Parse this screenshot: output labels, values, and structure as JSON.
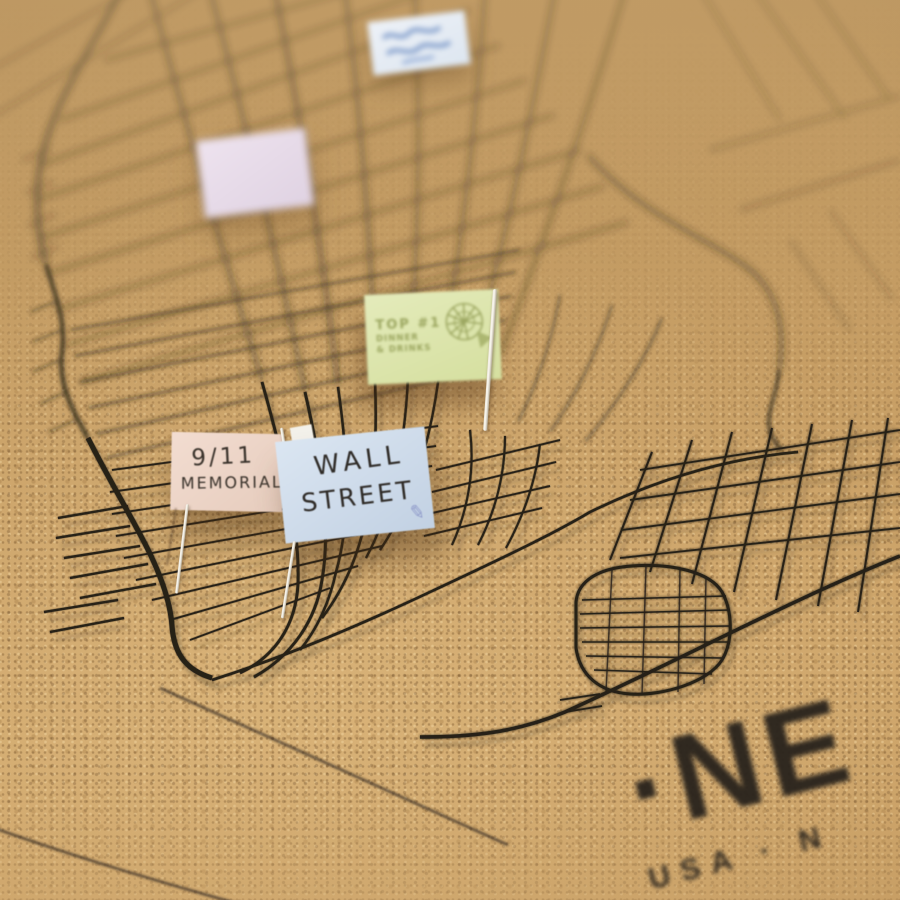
{
  "scene": {
    "caption": "Close-up photo of a cork pinboard street map of New York with paper flag pins"
  },
  "board_text": {
    "title_fragment": "·NE",
    "subtitle_fragment": "USA · N"
  },
  "colors": {
    "cork": "#c89d63",
    "map_ink": "#262019",
    "pin_metal": "#d9d4c8"
  },
  "flags": {
    "top_note": {
      "color": "#e9eef6",
      "text": ""
    },
    "lavender_note": {
      "color": "#e5dae8",
      "text": ""
    },
    "green_note": {
      "color": "#dce4ac",
      "ink": "#96a159",
      "line1": "TOP #1",
      "line2": "DINNER",
      "line3": "& DRINKS",
      "icon": "pie-stamp"
    },
    "pink_note": {
      "color": "#eed8cb",
      "ink": "#39322b",
      "line1": "9/11",
      "line2": "MEMORIAL"
    },
    "blue_note": {
      "color": "#cfdcea",
      "ink": "#2f2b27",
      "line1": "WALL",
      "line2": "STREET",
      "icon": "pencil",
      "icon_glyph": "✎",
      "icon_color": "#8d98c9"
    }
  }
}
